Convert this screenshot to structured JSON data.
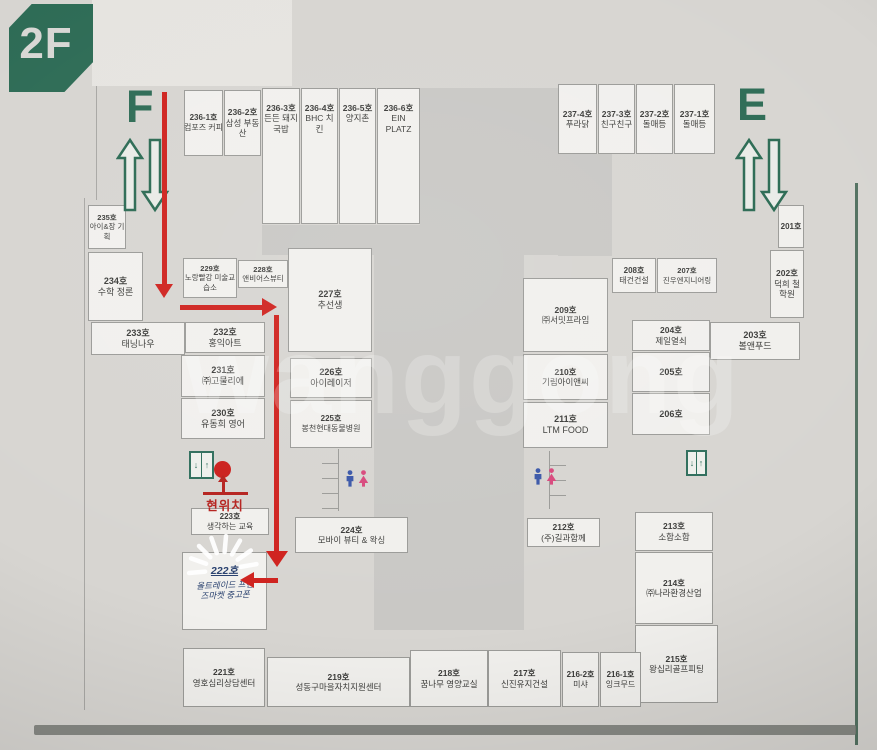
{
  "floor_label": "2F",
  "watermark": "wanggong",
  "landmarks": {
    "escalator_f_label": "F",
    "escalator_e_label": "E",
    "current_location_label": "현위치",
    "elevator": {
      "down": "↓",
      "up": "↑"
    }
  },
  "colors": {
    "signage_green": "#2d6b55",
    "path_red": "#cf221e",
    "room_fill": "#f1f0ed",
    "courtyard_gray": "#c9c8c5",
    "background_gray": "#d7d5d1",
    "restroom_male_blue": "#3a57a8",
    "restroom_female_pink": "#d8487c",
    "highlight_navy": "#28406e"
  },
  "rooms": {
    "r236_1": {
      "no": "236-1호",
      "name": "컴포즈 커피"
    },
    "r236_2": {
      "no": "236-2호",
      "name": "삼성 부동산"
    },
    "r236_3": {
      "no": "236-3호",
      "name": "든든 돼지국밥"
    },
    "r236_4": {
      "no": "236-4호",
      "name": "BHC 치킨"
    },
    "r236_5": {
      "no": "236-5호",
      "name": "양지촌"
    },
    "r236_6": {
      "no": "236-6호",
      "name": "EIN PLATZ"
    },
    "r237_4": {
      "no": "237-4호",
      "name": "푸라닭"
    },
    "r237_3": {
      "no": "237-3호",
      "name": "친구친구"
    },
    "r237_2": {
      "no": "237-2호",
      "name": "돌매등"
    },
    "r237_1": {
      "no": "237-1호",
      "name": "돌매등"
    },
    "r235": {
      "no": "235호",
      "name": "아이&장 기획"
    },
    "r234": {
      "no": "234호",
      "name": "수학 정론"
    },
    "r233": {
      "no": "233호",
      "name": "태닝나우"
    },
    "r232": {
      "no": "232호",
      "name": "홍익아트"
    },
    "r231": {
      "no": "231호",
      "name": "㈜고물리에"
    },
    "r230": {
      "no": "230호",
      "name": "유동희 영어"
    },
    "r229": {
      "no": "229호",
      "name": "노랑빨강 미술교습소"
    },
    "r228": {
      "no": "228호",
      "name": "앤비어스뷰티"
    },
    "r227": {
      "no": "227호",
      "name": "추선생"
    },
    "r226": {
      "no": "226호",
      "name": "아이레이저"
    },
    "r225": {
      "no": "225호",
      "name": "봉천현대동물병원"
    },
    "r224": {
      "no": "224호",
      "name": "모바이 뷰티 & 왁싱"
    },
    "r223": {
      "no": "223호",
      "name": "생각하는 교육"
    },
    "r222": {
      "no": "222호",
      "name": "올트레이드 프랜즈마켓 중고폰"
    },
    "r221": {
      "no": "221호",
      "name": "영호심리상담센터"
    },
    "r219": {
      "no": "219호",
      "name": "성동구마을자치지원센터"
    },
    "r218": {
      "no": "218호",
      "name": "꿈나무 영양교실"
    },
    "r217": {
      "no": "217호",
      "name": "신진유지건설"
    },
    "r216_2": {
      "no": "216-2호",
      "name": "미샤"
    },
    "r216_1": {
      "no": "216-1호",
      "name": "잉크무드"
    },
    "r215": {
      "no": "215호",
      "name": "왕십리골프피팅"
    },
    "r214": {
      "no": "214호",
      "name": "㈜나라환경산업"
    },
    "r213": {
      "no": "213호",
      "name": "소합소합"
    },
    "r212": {
      "no": "212호",
      "name": "(주)길과함께"
    },
    "r211": {
      "no": "211호",
      "name": "LTM FOOD"
    },
    "r210": {
      "no": "210호",
      "name": "기림아이앤씨"
    },
    "r209": {
      "no": "209호",
      "name": "㈜서밋프라임"
    },
    "r208": {
      "no": "208호",
      "name": "태건건설"
    },
    "r207": {
      "no": "207호",
      "name": "진우엔지니어링"
    },
    "r206": {
      "no": "206호",
      "name": ""
    },
    "r205": {
      "no": "205호",
      "name": ""
    },
    "r204": {
      "no": "204호",
      "name": "제일열쇠"
    },
    "r203": {
      "no": "203호",
      "name": "볼앤푸드"
    },
    "r202": {
      "no": "202호",
      "name": "덕희 철학원"
    },
    "r201": {
      "no": "201호",
      "name": ""
    }
  }
}
